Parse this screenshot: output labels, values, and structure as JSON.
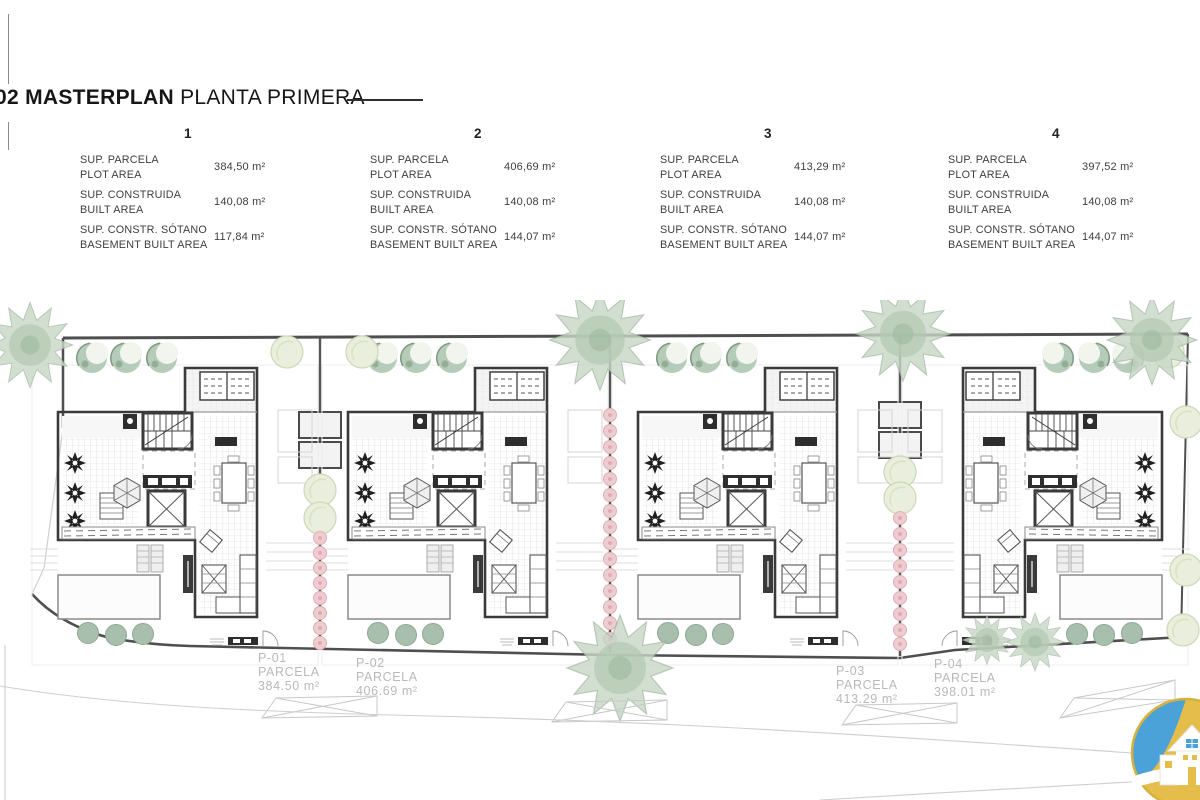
{
  "header": {
    "sheet_number": "02",
    "title_bold": "MASTERPLAN",
    "title_regular": "PLANTA PRIMERA"
  },
  "units_table": {
    "row_labels": [
      {
        "es": "SUP. PARCELA",
        "en": "PLOT AREA"
      },
      {
        "es": "SUP. CONSTRUIDA",
        "en": "BUILT AREA"
      },
      {
        "es": "SUP. CONSTR. SÓTANO",
        "en": "BASEMENT BUILT AREA"
      }
    ],
    "units": [
      {
        "number": "1",
        "plot_area": "384,50 m²",
        "built_area": "140,08 m²",
        "basement_area": "117,84 m²"
      },
      {
        "number": "2",
        "plot_area": "406,69 m²",
        "built_area": "140,08 m²",
        "basement_area": "144,07 m²"
      },
      {
        "number": "3",
        "plot_area": "413,29 m²",
        "built_area": "140,08 m²",
        "basement_area": "144,07 m²"
      },
      {
        "number": "4",
        "plot_area": "397,52 m²",
        "built_area": "140,08 m²",
        "basement_area": "144,07 m²"
      }
    ]
  },
  "parcels": [
    {
      "id": "P-01",
      "label": "PARCELA",
      "area": "384.50 m²"
    },
    {
      "id": "P-02",
      "label": "PARCELA",
      "area": "406.69 m²"
    },
    {
      "id": "P-03",
      "label": "PARCELA",
      "area": "413.29 m²"
    },
    {
      "id": "P-04",
      "label": "PARCELA",
      "area": "398.01 m²"
    }
  ],
  "colors": {
    "wall_dark": "#3a3a3a",
    "boundary": "#4f4f4f",
    "grid_line": "#d4d4d4",
    "tree_green": "#c6d6c4",
    "bush_green": "#b6ccba",
    "tree_light": "#e9efdc",
    "hedge_pink": "#eecdd1",
    "label_gray": "#b9b9b9",
    "logo_blue": "#4aa2d9",
    "logo_yellow": "#e4bd4a"
  }
}
